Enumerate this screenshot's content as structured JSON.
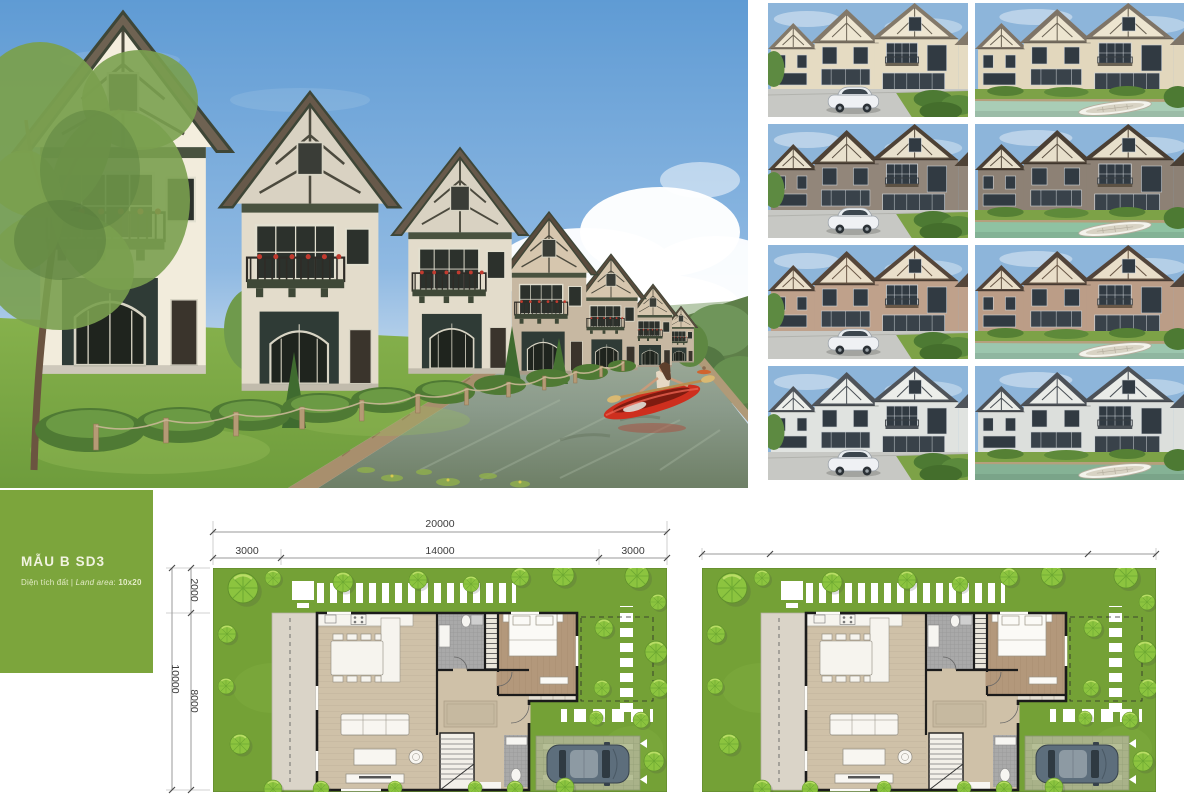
{
  "colors": {
    "brand_green": "#7CA53C",
    "card_title": "#F1F3E0",
    "card_subtitle": "#E3EBC6",
    "plan_lawn": "#74A136",
    "kayak_red": "#CE2F1E",
    "dim_text": "#3C3C3C"
  },
  "label_card": {
    "title": "MẪU B SD3",
    "subtitle_prefix": "Diện tích đất | ",
    "subtitle_italic": "Land area",
    "subtitle_sep": ": ",
    "subtitle_value": "10x20"
  },
  "floor_plan": {
    "overall_width": "20000",
    "top_segments": [
      "3000",
      "14000",
      "3000"
    ],
    "overall_height": "10000",
    "left_segments": [
      "2000",
      "8000"
    ]
  },
  "thumbnails": {
    "items": [
      {
        "name": "variant-cream-street",
        "view": "street",
        "wall": "#E5DBC2",
        "gable": "#EEE6D2",
        "roof": "#83796A",
        "timber": "#6B6354"
      },
      {
        "name": "variant-cream-canal",
        "view": "canal",
        "wall": "#E2D7BD",
        "gable": "#EDE5D0",
        "roof": "#7E7467",
        "timber": "#6B6354",
        "water": "#A9CDB6"
      },
      {
        "name": "variant-brown-street",
        "view": "street",
        "wall": "#92867A",
        "gable": "#E9E1CD",
        "roof": "#4E4236",
        "timber": "#5D5244"
      },
      {
        "name": "variant-brown-canal",
        "view": "canal",
        "wall": "#8D8175",
        "gable": "#E7DFCB",
        "roof": "#4A3F34",
        "timber": "#5D5244",
        "water": "#8FC2A2"
      },
      {
        "name": "variant-rose-street",
        "view": "street",
        "wall": "#BFA18B",
        "gable": "#EADFCA",
        "roof": "#55463A",
        "timber": "#6A5847"
      },
      {
        "name": "variant-rose-canal",
        "view": "canal",
        "wall": "#BB9D87",
        "gable": "#E9DEC9",
        "roof": "#52443A",
        "timber": "#6A5847",
        "water": "#9CC6AE"
      },
      {
        "name": "variant-gray-street",
        "view": "street",
        "wall": "#E0E3E0",
        "gable": "#ECEEEA",
        "roof": "#4F545A",
        "timber": "#4A5056"
      },
      {
        "name": "variant-gray-canal",
        "view": "canal",
        "wall": "#DCDFDC",
        "gable": "#EAECE8",
        "roof": "#4C5157",
        "timber": "#4A5056",
        "water": "#85B295"
      }
    ]
  }
}
